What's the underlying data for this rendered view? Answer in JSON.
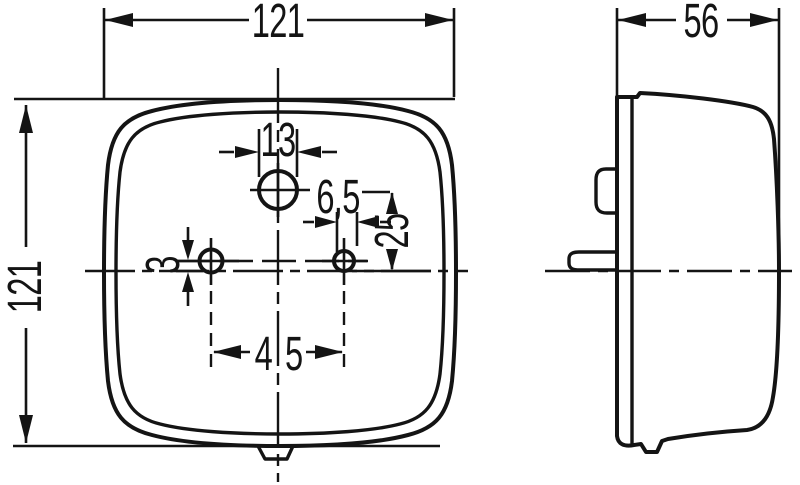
{
  "drawing": {
    "background": "#ffffff",
    "ink": "#141414",
    "kind": "technical dimension drawing, front view and side view of rounded-square lamp"
  },
  "dims": {
    "front_width": "121",
    "front_height": "121",
    "depth": "56",
    "top_hole_dia": "13",
    "small_hole_dia": "6,5",
    "hole_vertical_offset": "25",
    "axis_offset": "3",
    "hole_spacing": "45"
  }
}
